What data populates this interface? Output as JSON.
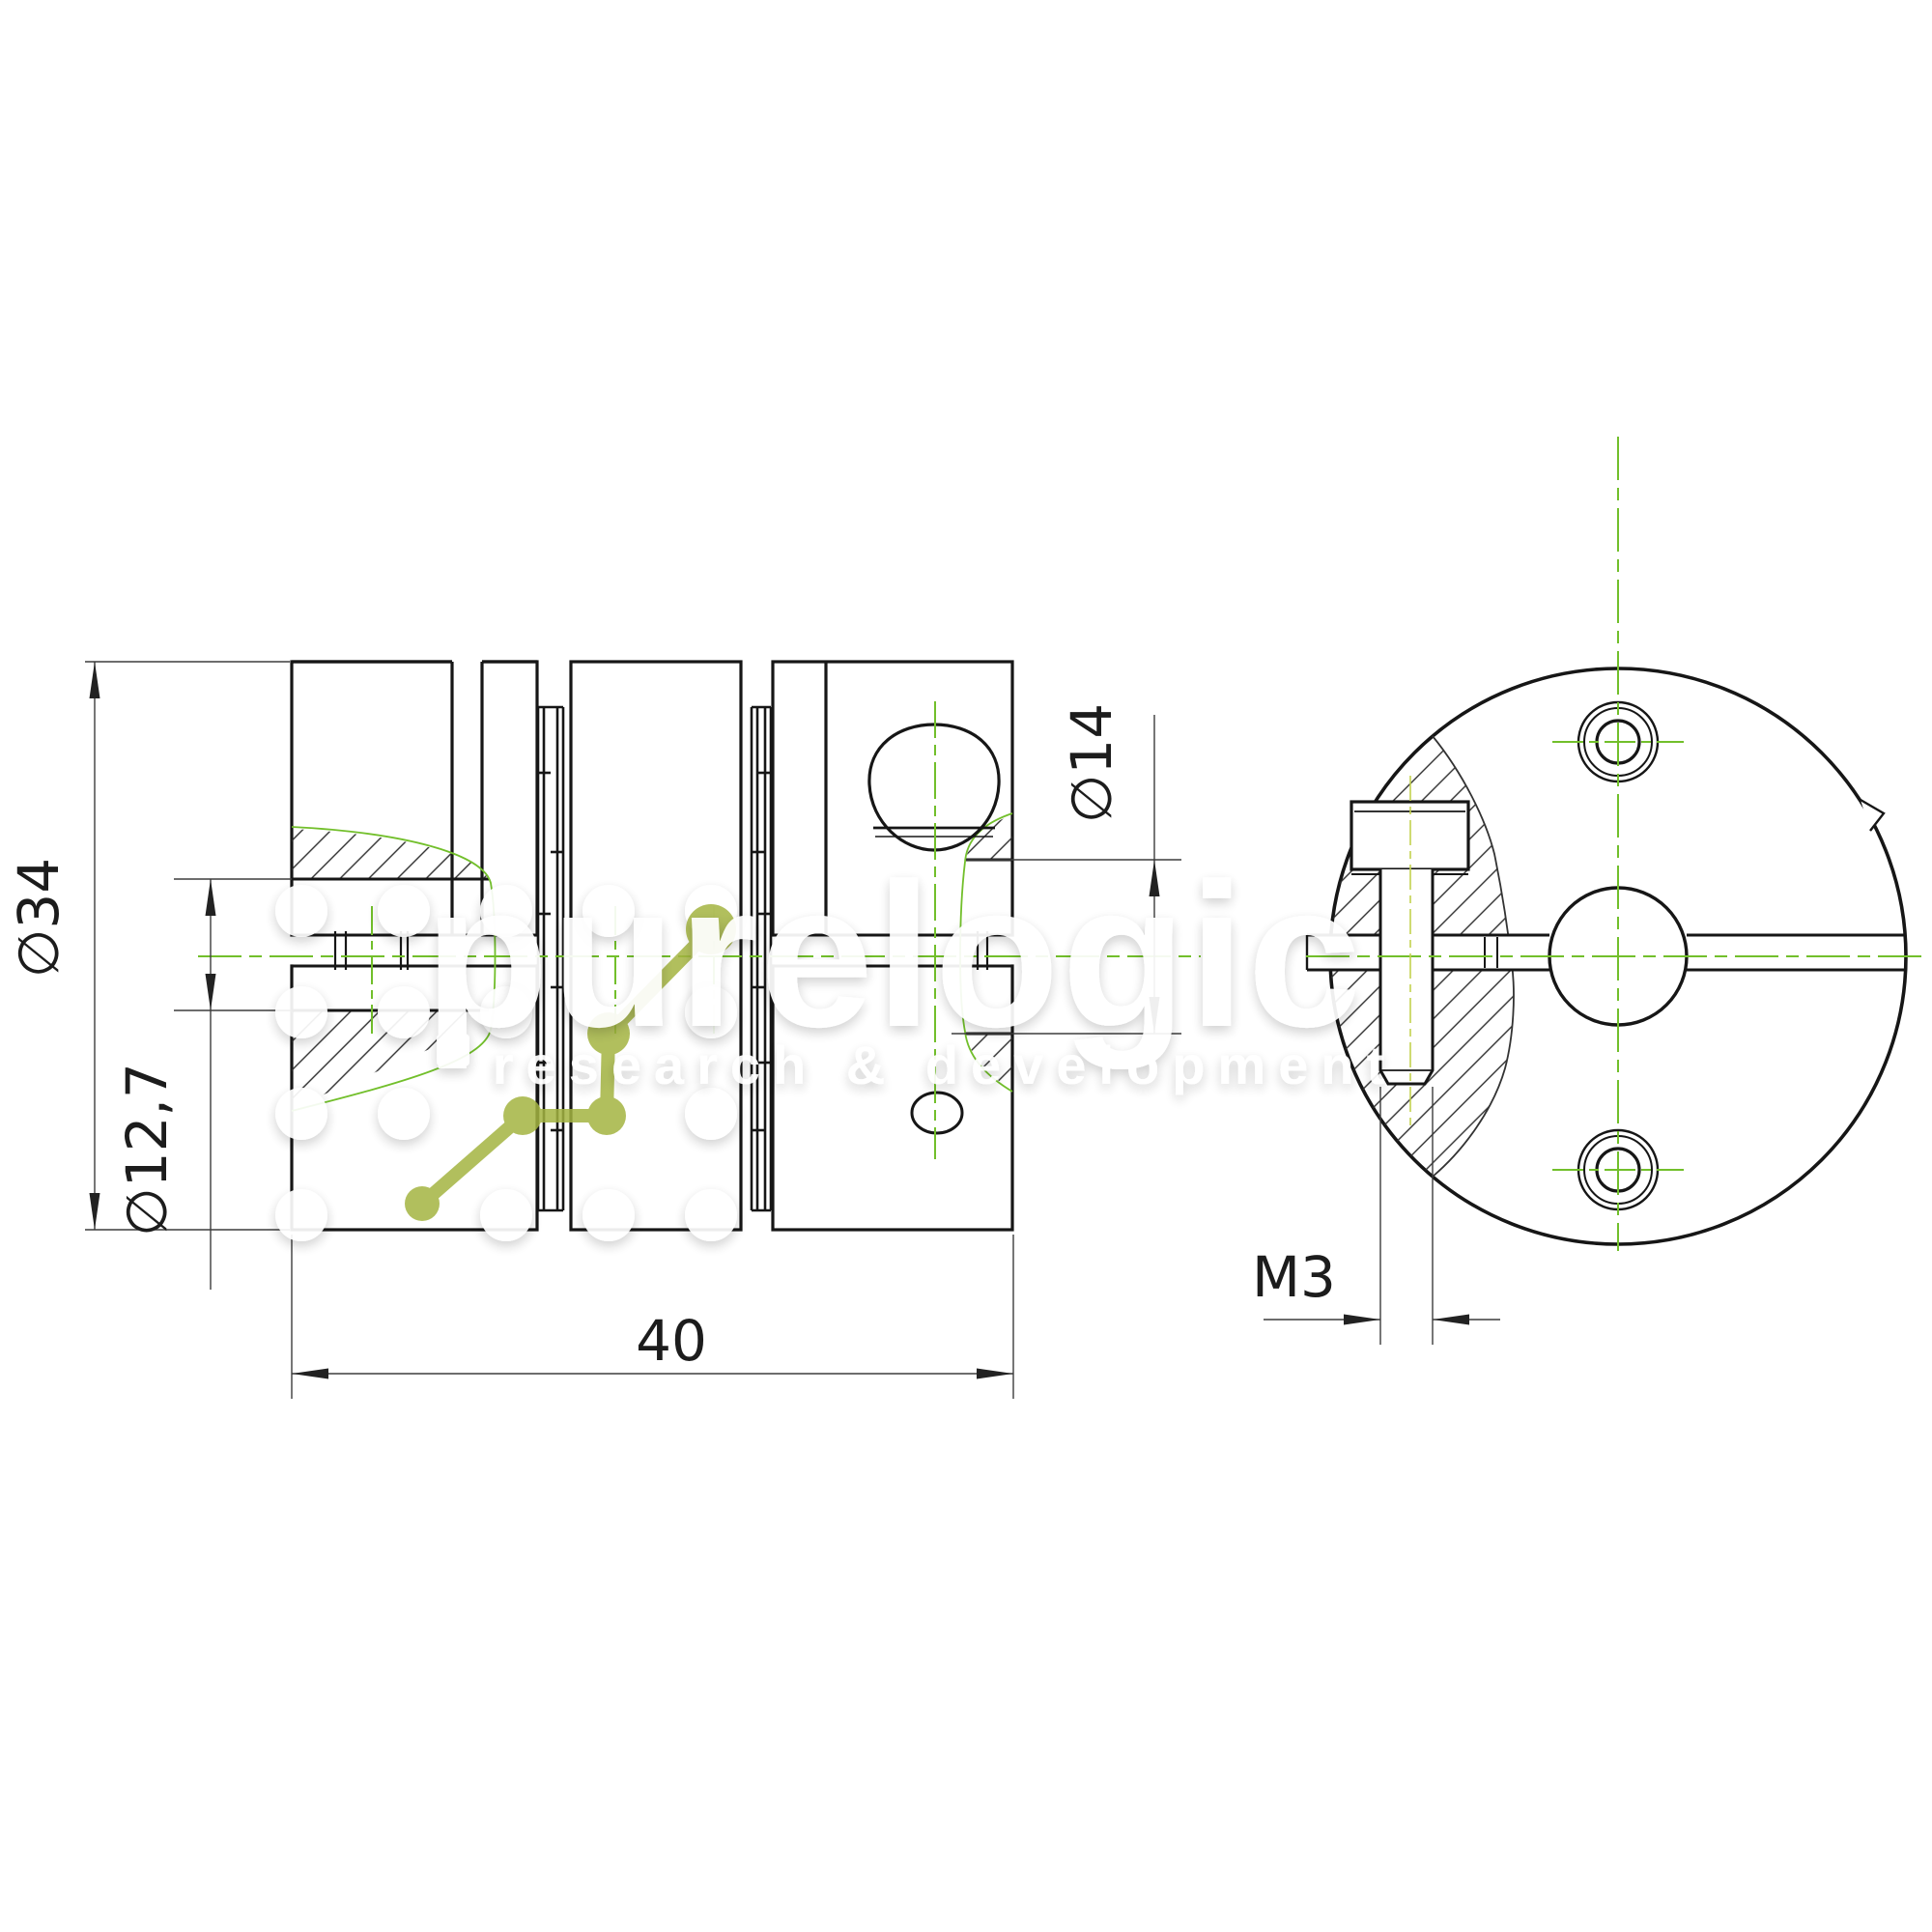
{
  "drawing": {
    "description": "CAD technical drawing of a double disc clamp shaft coupling, side section view and front view",
    "views": {
      "left": "side section view",
      "right": "front view"
    },
    "dimensions": {
      "outer_diameter": "∅34",
      "bore_left": "∅12,7",
      "bore_right": "∅14",
      "length": "40",
      "thread": "M3"
    },
    "colors": {
      "line": "#161616",
      "thin_line": "#3d3d3d",
      "centerline_green": "#72bf2b",
      "screw_centerline_green": "#c3d24f",
      "logo_green": "#a4b441"
    },
    "watermark": {
      "brand": "purelogic",
      "tagline": "research & development"
    }
  }
}
